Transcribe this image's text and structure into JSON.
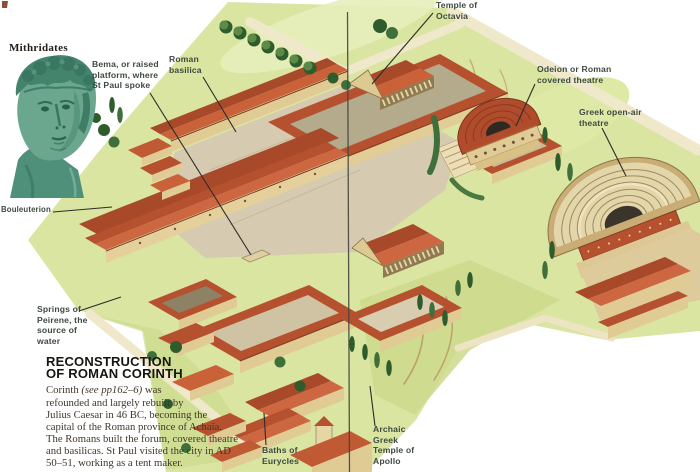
{
  "labels": {
    "mithridates": {
      "text": "Mithridates"
    },
    "bema": {
      "text": "Bema, or raised\nplatform, where\nSt Paul spoke"
    },
    "roman_basilica": {
      "text": "Roman\nbasilica"
    },
    "temple_octavia": {
      "text": "Temple of\nOctavia"
    },
    "odeion": {
      "text": "Odeion or Roman\ncovered theatre"
    },
    "greek_theatre": {
      "text": "Greek open-air\ntheatre"
    },
    "bouleuterion": {
      "text": "Bouleuterion"
    },
    "springs_peirene": {
      "text": "Springs of\nPeirene, the\nsource of\nwater"
    },
    "baths_eurycles": {
      "text": "Baths of\nEurycles"
    },
    "temple_apollo": {
      "text": "Archaic\nGreek\nTemple of\nApollo"
    }
  },
  "info_block": {
    "title_line1": "RECONSTRUCTION",
    "title_line2": "OF ROMAN CORINTH",
    "body_start": "Corinth ",
    "body_ref": "(see pp162–6)",
    "body_rest": " was refounded and largely rebuilt by Julius Caesar in 46 BC, becoming the capital of the Roman province of Achaïa. The Romans built the forum, covered theatre and basilicas. St Paul visited the city in AD 50–51, working as a tent maker."
  },
  "palette": {
    "roof_terracotta": "#b5512f",
    "wall_tan": "#e0cb95",
    "lawn_green": "#d9e5a1",
    "stone": "#d6cab0",
    "tree_green": "#2f5c2c",
    "bronze_teal": "#5e9d88",
    "label_text": "#3e4a41",
    "body_text": "#413729",
    "leader_line": "#2d2d28"
  }
}
